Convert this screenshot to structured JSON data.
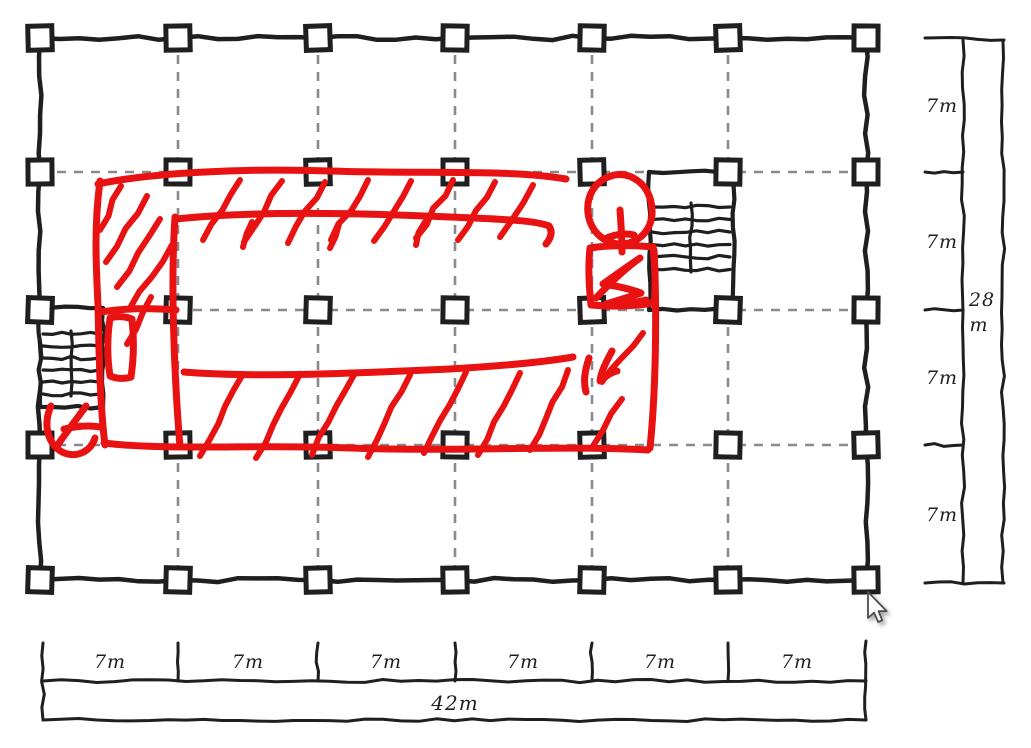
{
  "app": {
    "background": "#ffffff",
    "ink_color": "#1f1f1f",
    "grid_color": "#8a8a8a",
    "marker_color": "#e81212"
  },
  "plan": {
    "description": "hand-sketched structural grid floor plan with two stair cores and a red marker corridor/circulation markup",
    "column_grid": {
      "columns": 7,
      "rows": 5,
      "bay": "7m"
    },
    "overall": {
      "width": "42m",
      "depth": "28m"
    }
  },
  "dimensions": {
    "bottom": {
      "segments": [
        "7m",
        "7m",
        "7m",
        "7m",
        "7m",
        "7m"
      ],
      "total": "42m"
    },
    "right": {
      "segments": [
        "7m",
        "7m",
        "7m",
        "7m"
      ],
      "total_value": "28",
      "total_unit": "m"
    }
  },
  "cursor": {
    "icon": "arrow-pointer"
  }
}
